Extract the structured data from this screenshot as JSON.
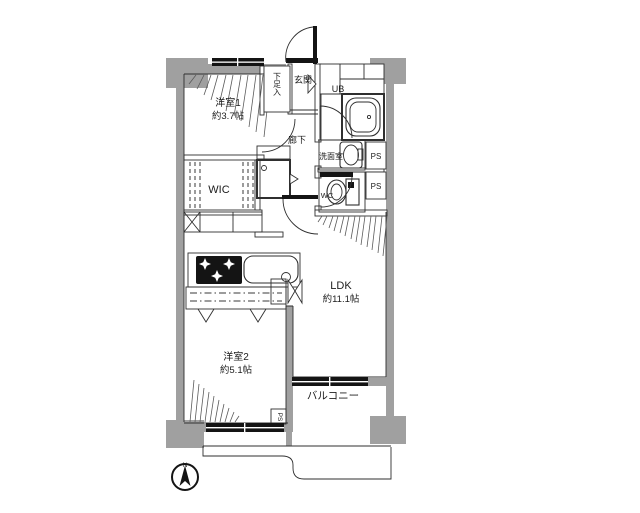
{
  "colors": {
    "wall": "#a0a0a0",
    "window": "#141414",
    "line": "#2f2f2f",
    "background": "#ffffff"
  },
  "rooms": {
    "bedroom1": {
      "name": "洋室1",
      "size": "約3.7帖"
    },
    "bedroom2": {
      "name": "洋室2",
      "size": "約5.1帖"
    },
    "ldk": {
      "name": "LDK",
      "size": "約11.1帖"
    },
    "wic": {
      "name": "WIC"
    },
    "entrance": {
      "name": "玄関"
    },
    "hallway": {
      "name": "廊下"
    },
    "shoe_storage": {
      "name": "下足入"
    },
    "unit_bath": {
      "name": "UB"
    },
    "washroom": {
      "name": "洗面室"
    },
    "toilet": {
      "name": "WC"
    },
    "balcony": {
      "name": "バルコニー"
    },
    "pipe_space_1": {
      "name": "PS"
    },
    "pipe_space_2": {
      "name": "PS"
    },
    "pipe_space_3": {
      "name": "PS"
    }
  },
  "compass": {
    "north_label": "N"
  }
}
